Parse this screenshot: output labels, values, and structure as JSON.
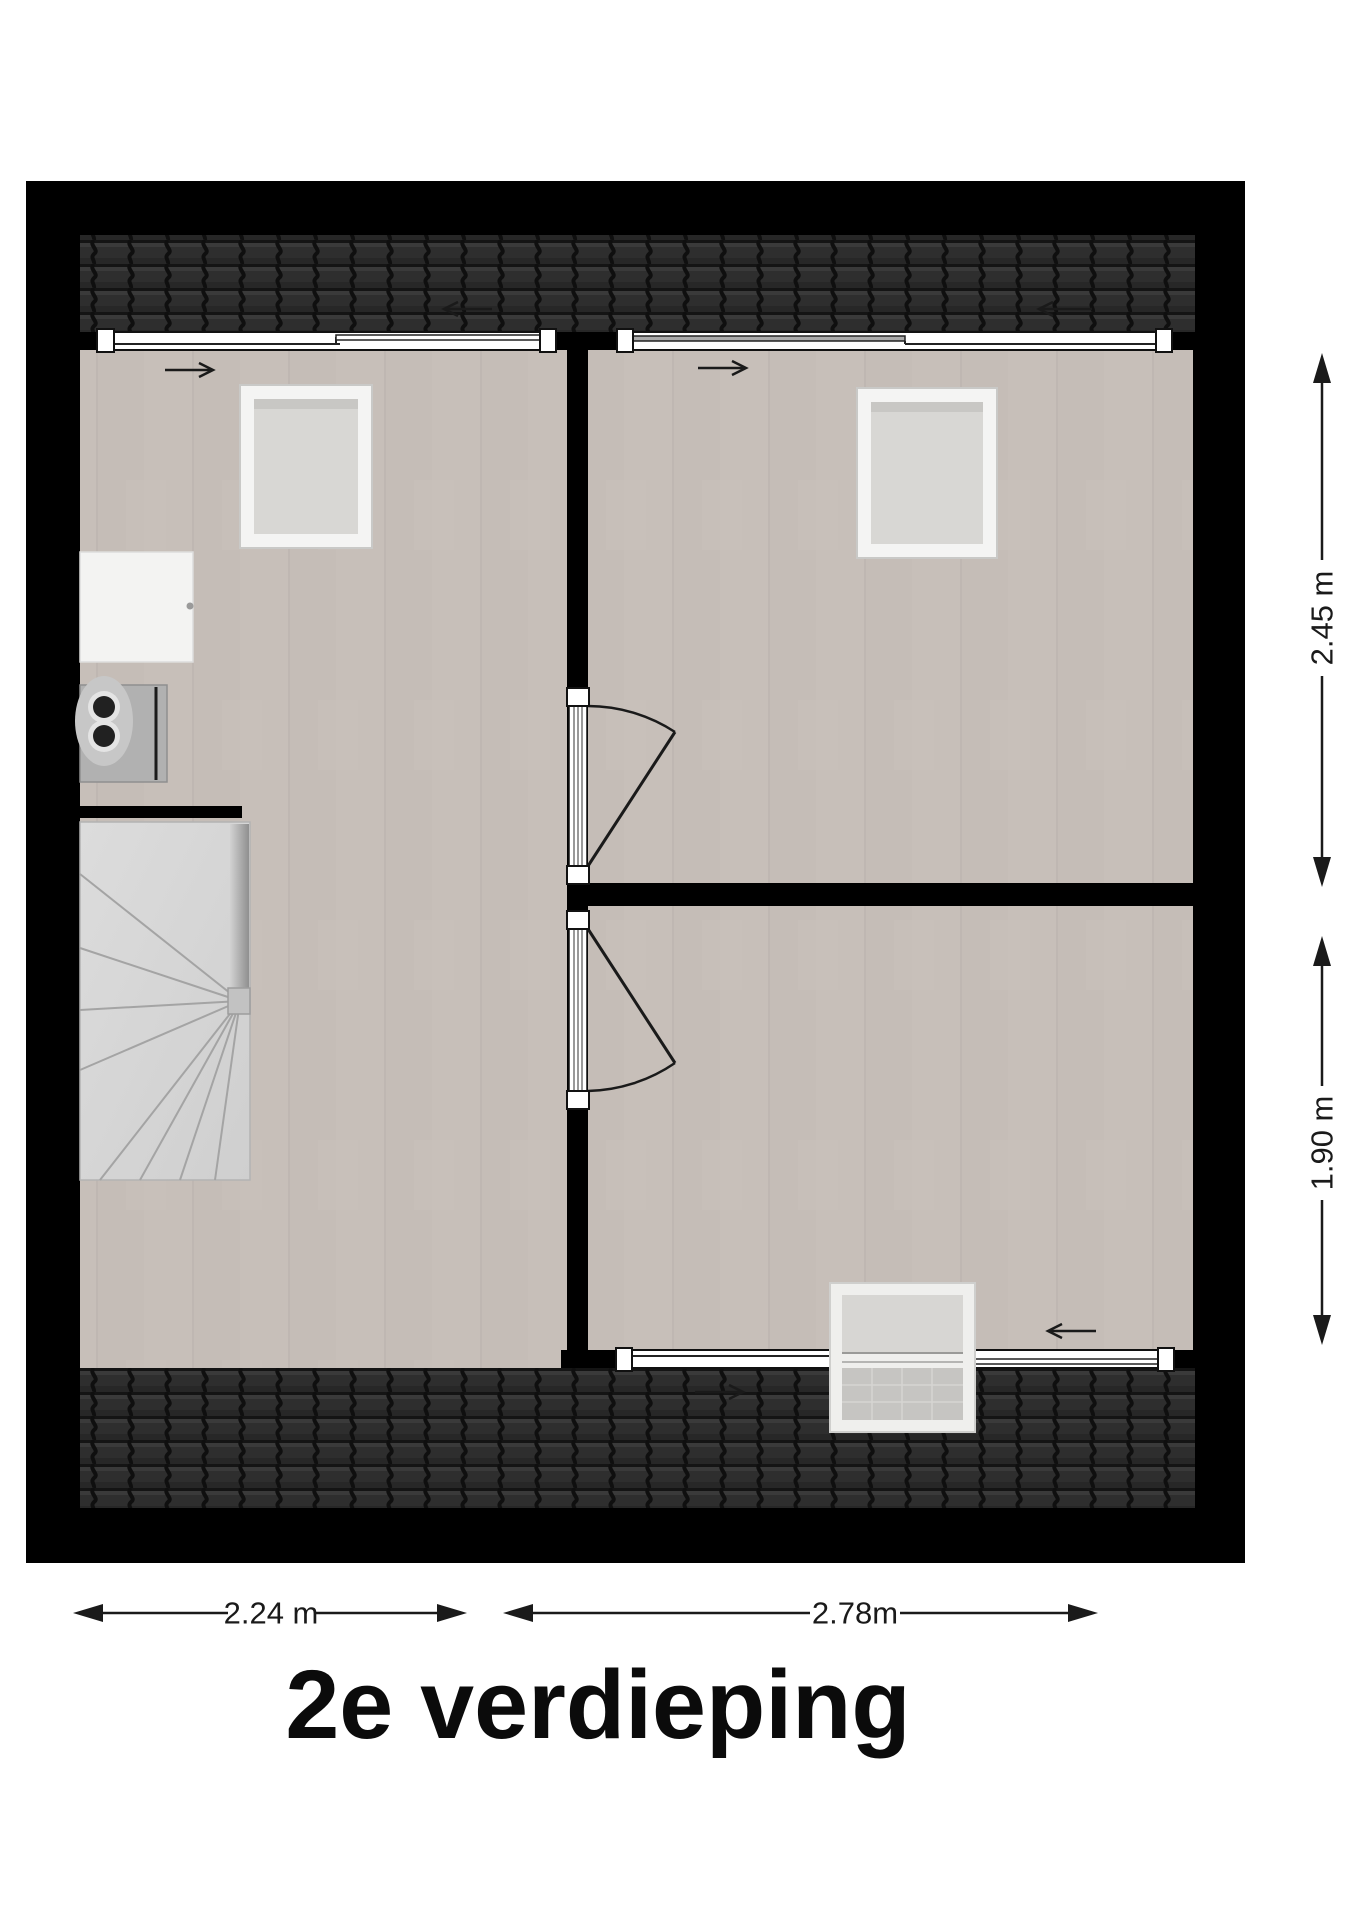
{
  "page": {
    "title": "2e verdieping",
    "type_note": "floor plan, attic storey with three rooms, spiral staircase, roof windows"
  },
  "dimensions": {
    "right_top": "2.45 m",
    "right_bottom": "1.90 m",
    "bottom_left": "2.24 m",
    "bottom_right": "2.78m"
  },
  "colors": {
    "wall": "#000000",
    "roof_tiles": "#2e2e2e",
    "roof_tile_gap": "#141414",
    "floor": "#c7bfb9",
    "stairs": "#d9d9d9",
    "window_frame": "#ffffff",
    "skylight_pane": "#d8d7d4",
    "appliance_gray": "#b1b1b1",
    "annotation": "#1a1a1a"
  },
  "icons": {
    "roof_arrow_top_left": "arrow-left-icon",
    "roof_arrow_top_right": "arrow-left-icon",
    "roof_arrow_bottom": "arrow-right-icon",
    "room_arrow_left": "arrow-right-icon",
    "room_arrow_top_right": "arrow-right-icon",
    "room_arrow_bottom_right": "arrow-left-icon",
    "dimension_heads": "dimension-arrow-icon"
  }
}
